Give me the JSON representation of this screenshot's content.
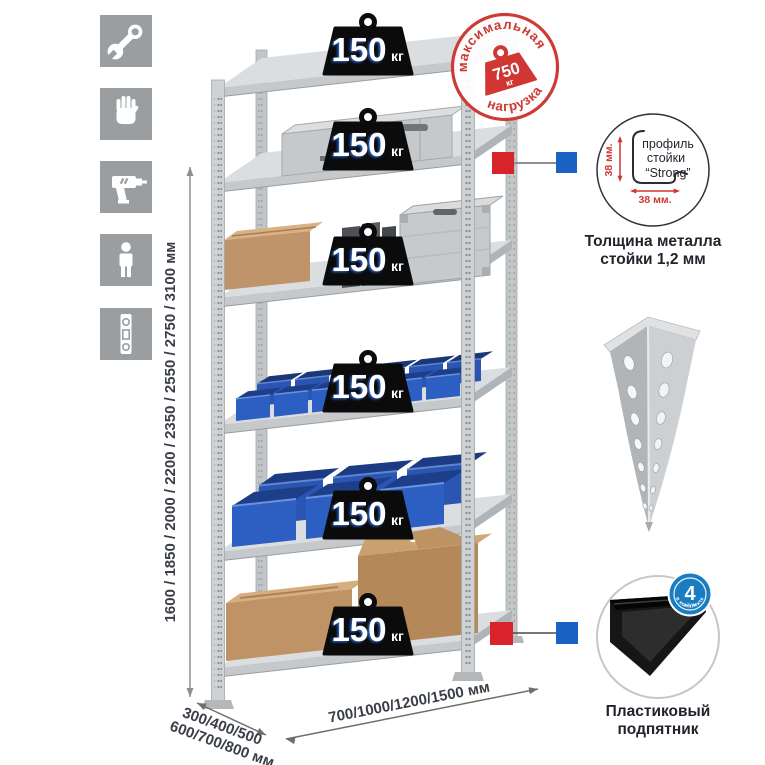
{
  "sidebar": {
    "icons": [
      "wrench",
      "gloves",
      "drill",
      "person",
      "level"
    ]
  },
  "dimensions": {
    "height": "1600 / 1850 / 2000 / 2200 / 2350 / 2550 / 2750 / 3100 мм",
    "depth_line1": "300/400/500",
    "depth_line2": "600/700/800 мм",
    "width": "700/1000/1200/1500 мм"
  },
  "shelf_load": {
    "value": "150",
    "unit": "кг"
  },
  "max_load_stamp": {
    "arc_top": "максимальная",
    "arc_bottom": "нагрузка",
    "value": "750",
    "unit": "кг"
  },
  "profile_callout": {
    "label_line1": "профиль",
    "label_line2": "стойки",
    "label_line3": "“Strong”",
    "dim_vertical": "38 мм.",
    "dim_horizontal": "38 мм.",
    "caption_line1": "Толщина металла",
    "caption_line2": "стойки 1,2 мм"
  },
  "foot_callout": {
    "badge_number": "4",
    "badge_sub": "штуки",
    "badge_arc": "в комплекте",
    "caption_line1": "Пластиковый",
    "caption_line2": "подпятник"
  },
  "colors": {
    "stamp_red": "#ce3a36",
    "marker_red": "#d8232a",
    "marker_blue": "#1a63c4",
    "badge_blue": "#1a7dc1",
    "bin_blue": "#2d5ec2",
    "tile_gray": "#9b9ea1"
  }
}
